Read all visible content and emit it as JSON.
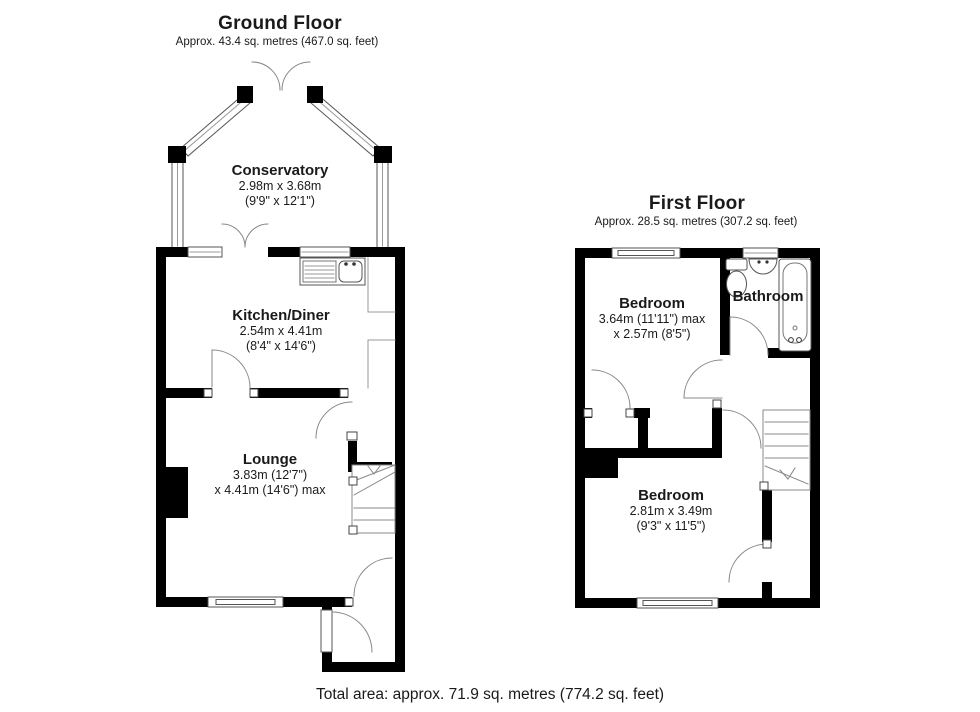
{
  "ground_floor": {
    "title": "Ground Floor",
    "subtitle": "Approx. 43.4 sq. metres (467.0 sq. feet)",
    "rooms": {
      "conservatory": {
        "name": "Conservatory",
        "dim_metric": "2.98m x 3.68m",
        "dim_imperial": "(9'9\" x 12'1\")"
      },
      "kitchen": {
        "name": "Kitchen/Diner",
        "dim_metric": "2.54m x 4.41m",
        "dim_imperial": "(8'4\" x 14'6\")"
      },
      "lounge": {
        "name": "Lounge",
        "dim_metric": "3.83m (12'7\")",
        "dim_imperial": "x 4.41m (14'6\") max"
      }
    }
  },
  "first_floor": {
    "title": "First Floor",
    "subtitle": "Approx. 28.5 sq. metres (307.2 sq. feet)",
    "rooms": {
      "bedroom1": {
        "name": "Bedroom",
        "dim_metric": "3.64m (11'11\") max",
        "dim_imperial": "x 2.57m (8'5\")"
      },
      "bathroom": {
        "name": "Bathroom"
      },
      "bedroom2": {
        "name": "Bedroom",
        "dim_metric": "2.81m x 3.49m",
        "dim_imperial": "(9'3\" x 11'5\")"
      }
    }
  },
  "footer": {
    "total_area": "Total area: approx. 71.9 sq. metres (774.2 sq. feet)"
  },
  "colors": {
    "wall": "#000000",
    "fixture_line": "#555555",
    "door_line": "#888888",
    "background": "#ffffff"
  }
}
